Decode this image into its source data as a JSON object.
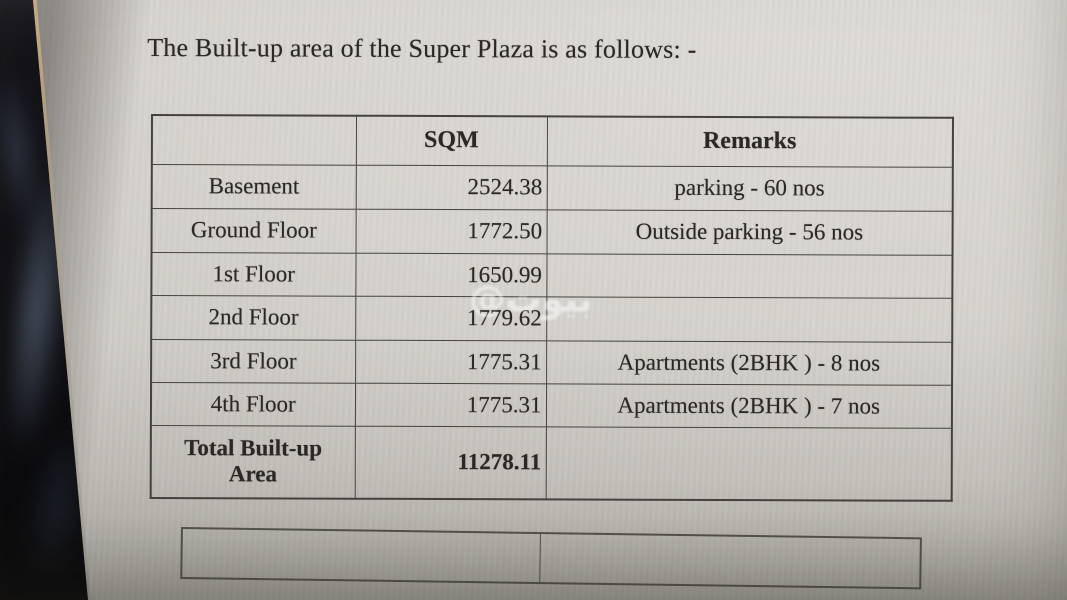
{
  "document": {
    "title": "The Built-up area of the Super Plaza is as follows: -"
  },
  "table": {
    "headers": {
      "col1": "",
      "col2": "SQM",
      "col3": "Remarks"
    },
    "rows": [
      {
        "label": "Basement",
        "sqm": "2524.38",
        "remarks": "parking - 60 nos"
      },
      {
        "label": "Ground Floor",
        "sqm": "1772.50",
        "remarks": "Outside parking - 56 nos"
      },
      {
        "label": "1st Floor",
        "sqm": "1650.99",
        "remarks": ""
      },
      {
        "label": "2nd Floor",
        "sqm": "1779.62",
        "remarks": ""
      },
      {
        "label": "3rd Floor",
        "sqm": "1775.31",
        "remarks": "Apartments (2BHK ) - 8 nos"
      },
      {
        "label": "4th Floor",
        "sqm": "1775.31",
        "remarks": "Apartments (2BHK ) - 7 nos"
      },
      {
        "label": "Total Built-up Area",
        "sqm": "11278.11",
        "remarks": ""
      }
    ]
  },
  "watermark": {
    "text": "@بيوت"
  },
  "empty_table": {
    "cells": [
      "",
      ""
    ]
  },
  "colors": {
    "paper": "#d7d4cf",
    "table_border": "#474440",
    "ink": "#2b2824",
    "watermark": "rgba(255,255,255,0.52)",
    "drape_dark": "#0e0e12",
    "drape_smoke": "#8294b2"
  }
}
